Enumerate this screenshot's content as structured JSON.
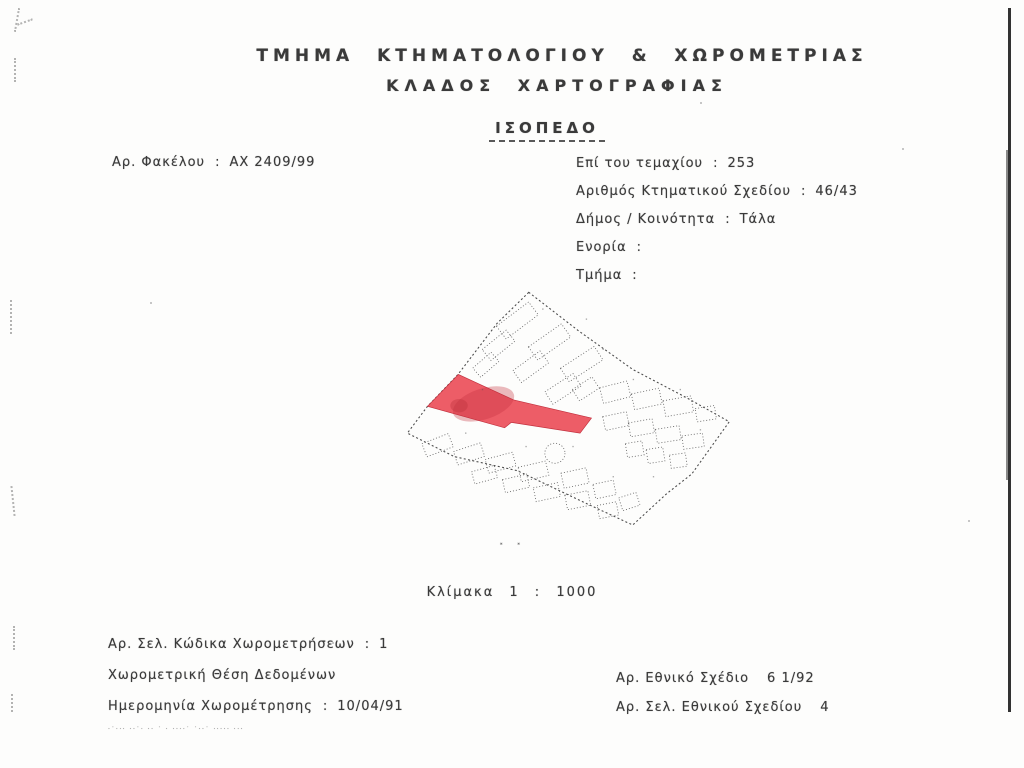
{
  "doc": {
    "title_line1": "ΤΜΗΜΑ ΚΤΗΜΑΤΟΛΟΓΙΟΥ & ΧΩΡΟΜΕΤΡΙΑΣ",
    "title_line2": "ΚΛΑΔΟΣ ΧΑΡΤΟΓΡΑΦΙΑΣ",
    "form_heading": "ΙΣΟΠΕΔΟ"
  },
  "fields": {
    "file_no": {
      "label": "Αρ. Φακέλου",
      "sep": ":",
      "value": "ΑΧ 2409/99"
    },
    "plot_no": {
      "label": "Επί του τεμαχίου",
      "sep": ":",
      "value": "253"
    },
    "cadastral_plan_no": {
      "label": "Αριθμός Κτηματικού Σχεδίου",
      "sep": ":",
      "value": "46/43"
    },
    "municipality": {
      "label": "Δήμος / Κοινότητα",
      "sep": ":",
      "value": "Τάλα"
    },
    "parish": {
      "label": "Ενορία",
      "sep": ":",
      "value": ""
    },
    "section": {
      "label": "Τμήμα",
      "sep": ":",
      "value": ""
    }
  },
  "map": {
    "scale_label": "Κλίμακα  1 :  1000",
    "highlight_color": "#e8505b",
    "highlight_edge_color": "#c03340",
    "line_color": "#5f5f5f",
    "boundary_color": "#4d4d4d"
  },
  "footer_left": {
    "survey_code_page": {
      "label": "Αρ. Σελ. Κώδικα Χωρομετρήσεων",
      "sep": ":",
      "value": "1"
    },
    "survey_position": {
      "label": "Χωρομετρική Θέση Δεδομένων",
      "sep": "",
      "value": ""
    },
    "survey_date": {
      "label": "Ημερομηνία Χωρομέτρησης",
      "sep": ":",
      "value": "10/04/91"
    },
    "microprint": "·˙··· ··˙· ·· ˙ · ····˙ ˙··˙ ····· ···"
  },
  "footer_right": {
    "national_plan": {
      "label": "Αρ. Εθνικό Σχέδιο",
      "sep": "",
      "value": "6 1/92"
    },
    "national_plan_page": {
      "label": "Αρ. Σελ. Εθνικού Σχεδίου",
      "sep": "",
      "value": "4"
    }
  }
}
